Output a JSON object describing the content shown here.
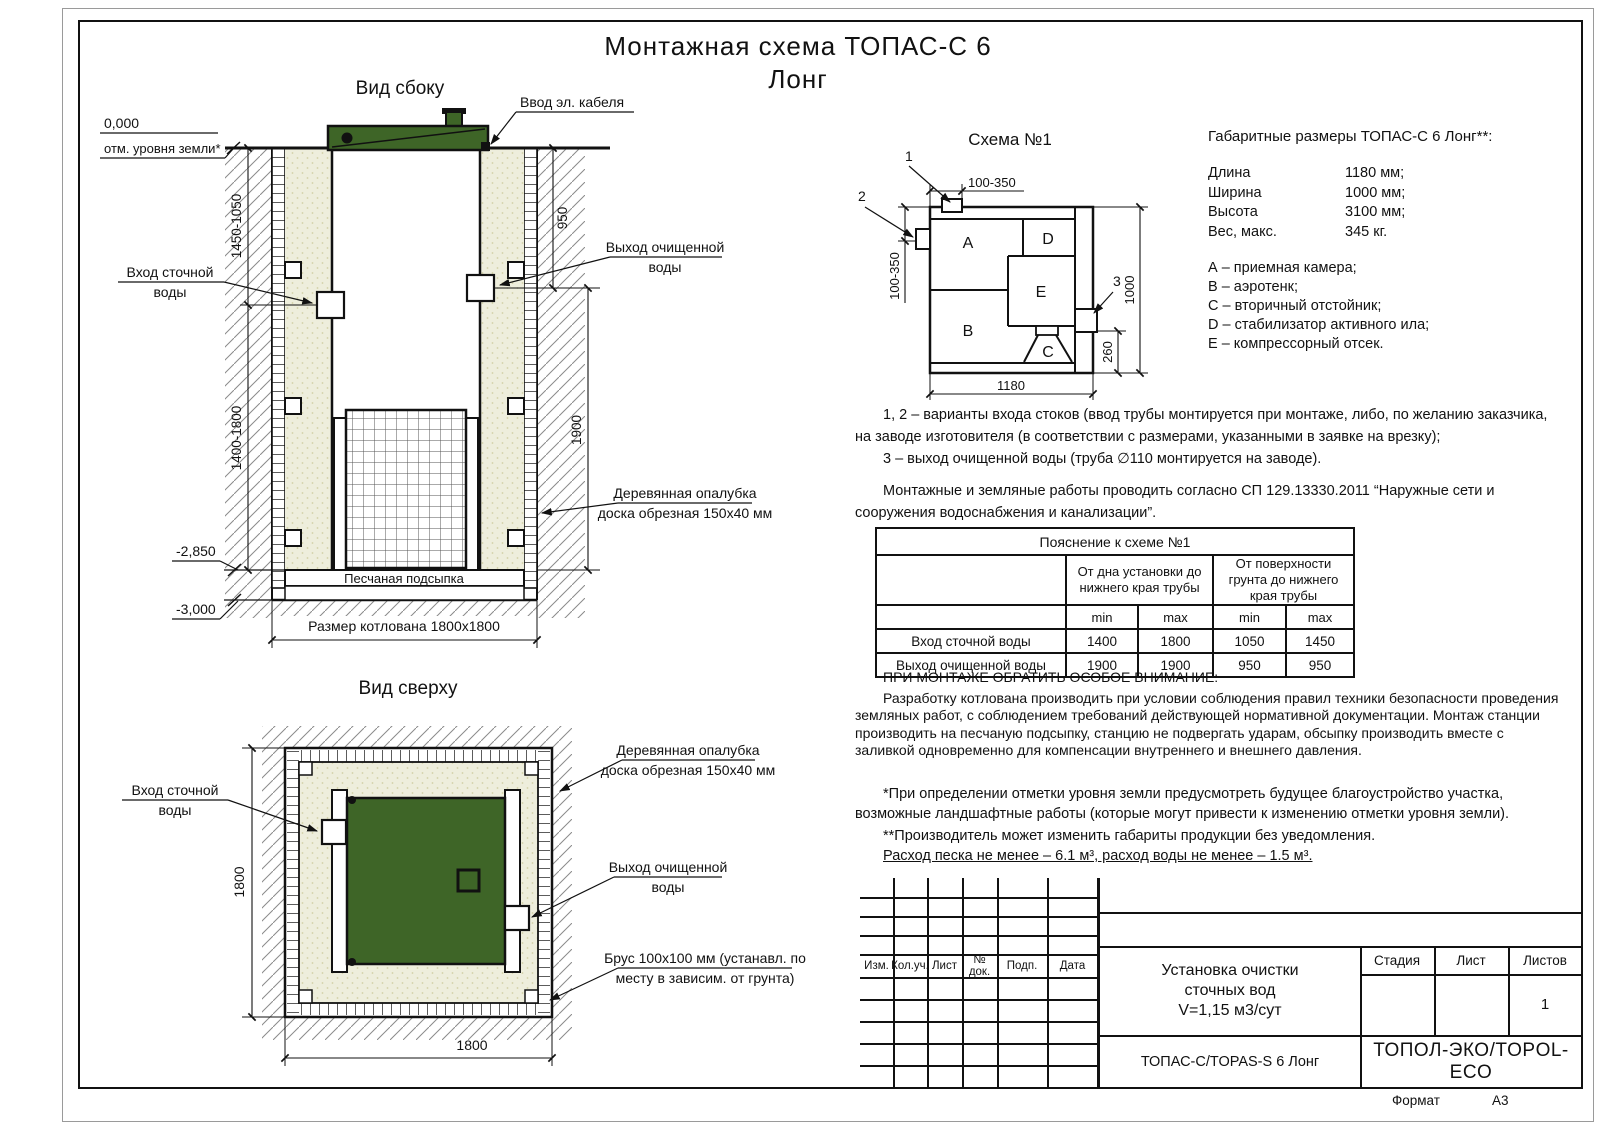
{
  "page": {
    "title_line1": "Монтажная схема ТОПАС-С 6",
    "title_line2": "Лонг",
    "format_label": "Формат",
    "format_value": "А3"
  },
  "side_view": {
    "title": "Вид сбоку",
    "labels": {
      "zero_mark": "0,000",
      "ground_level": "отм. уровня земли*",
      "cable_entry": "Ввод эл. кабеля",
      "inlet_l1": "Вход сточной",
      "inlet_l2": "воды",
      "outlet_l1": "Выход очищенной",
      "outlet_l2": "воды",
      "formwork_l1": "Деревянная опалубка",
      "formwork_l2": "доска обрезная 150х40 мм",
      "sand_bed": "Песчаная подсыпка",
      "pit_size": "Размер котлована 1800х1800",
      "elev_2850": "-2,850",
      "elev_3000": "-3,000"
    },
    "dims": {
      "left_upper": "1450-1050",
      "left_lower": "1400-1800",
      "right_upper": "950",
      "right_lower": "1900"
    }
  },
  "top_view": {
    "title": "Вид сверху",
    "labels": {
      "inlet_l1": "Вход сточной",
      "inlet_l2": "воды",
      "formwork_l1": "Деревянная опалубка",
      "formwork_l2": "доска обрезная 150х40 мм",
      "outlet_l1": "Выход очищенной",
      "outlet_l2": "воды",
      "beam_l1": "Брус 100х100 мм (устанавл. по",
      "beam_l2": "месту в зависим. от грунта)"
    },
    "dims": {
      "width": "1800",
      "height": "1800"
    }
  },
  "schema": {
    "title": "Схема №1",
    "compartments": {
      "a": "A",
      "b": "B",
      "c": "C",
      "d": "D",
      "e": "E"
    },
    "callouts": {
      "c1": "1",
      "c2": "2",
      "c3": "3"
    },
    "dims": {
      "top": "100-350",
      "left": "100-350",
      "width": "1180",
      "height": "1000",
      "outlet": "260"
    }
  },
  "specs": {
    "heading": "Габаритные размеры ТОПАС-С 6 Лонг**:",
    "rows": [
      {
        "label": "Длина",
        "value": "1180 мм;"
      },
      {
        "label": "Ширина",
        "value": "1000 мм;"
      },
      {
        "label": "Высота",
        "value": "3100 мм;"
      },
      {
        "label": "Вес, макс.",
        "value": "345 кг."
      }
    ],
    "legend": [
      "А – приемная камера;",
      "В – аэротенк;",
      "С – вторичный отстойник;",
      "D – стабилизатор активного ила;",
      "Е – компрессорный отсек."
    ]
  },
  "notes": {
    "variants": "1, 2 – варианты входа  стоков (ввод трубы монтируется при монтаже, либо, по желанию заказчика, на заводе изготовителя (в соответствии с размерами, указанными в заявке на врезку);",
    "outlet": "3 – выход очищенной воды (труба ∅110 монтируется на заводе).",
    "sp": "Монтажные и земляные работы проводить согласно СП 129.13330.2011 “Наружные сети и сооружения водоснабжения и канализации”."
  },
  "table": {
    "title": "Пояснение к схеме №1",
    "col_group1": "От дна установки до нижнего края трубы",
    "col_group2": "От поверхности грунта до нижнего края трубы",
    "min_label": "min",
    "max_label": "max",
    "rows": [
      {
        "label": "Вход сточной воды",
        "v1": "1400",
        "v2": "1800",
        "v3": "1050",
        "v4": "1450"
      },
      {
        "label": "Выход очищенной воды",
        "v1": "1900",
        "v2": "1900",
        "v3": "950",
        "v4": "950"
      }
    ]
  },
  "attention": {
    "heading": "ПРИ МОНТАЖЕ ОБРАТИТЬ ОСОБОЕ ВНИМАНИЕ:",
    "body": "Разработку котлована производить при условии соблюдения правил техники безопасности проведения земляных работ, с соблюдением требований действующей нормативной документации. Монтаж станции производить на песчаную подсыпку, станцию не подвергать ударам, обсыпку производить вместе с заливкой одновременно для компенсации внутреннего и внешнего давления."
  },
  "footnotes": {
    "f1": "*При определении отметки уровня земли предусмотреть будущее благоустройство участка, возможные ландшафтные работы (которые могут привести к изменению отметки уровня земли).",
    "f2": "**Производитель может изменить габариты продукции без уведомления.",
    "consumption": "Расход песка не менее – 6.1 м³, расход воды не менее – 1.5 м³."
  },
  "title_block": {
    "rev_headers": [
      "Изм.",
      "Кол.уч.",
      "Лист",
      "№ док.",
      "Подп.",
      "Дата"
    ],
    "doc_title_l1": "Установка очистки",
    "doc_title_l2": "сточных вод",
    "doc_title_l3": "V=1,15 м3/сут",
    "product": "ТОПАС-С/TOPAS-S 6 Лонг",
    "stage": "Стадия",
    "sheet": "Лист",
    "sheets": "Листов",
    "sheets_value": "1",
    "company": "ТОПОЛ-ЭКО/TOPOL-ECO"
  },
  "colors": {
    "lid_green": "#3e6527",
    "sand": "#eeeedc",
    "line": "#111111"
  }
}
